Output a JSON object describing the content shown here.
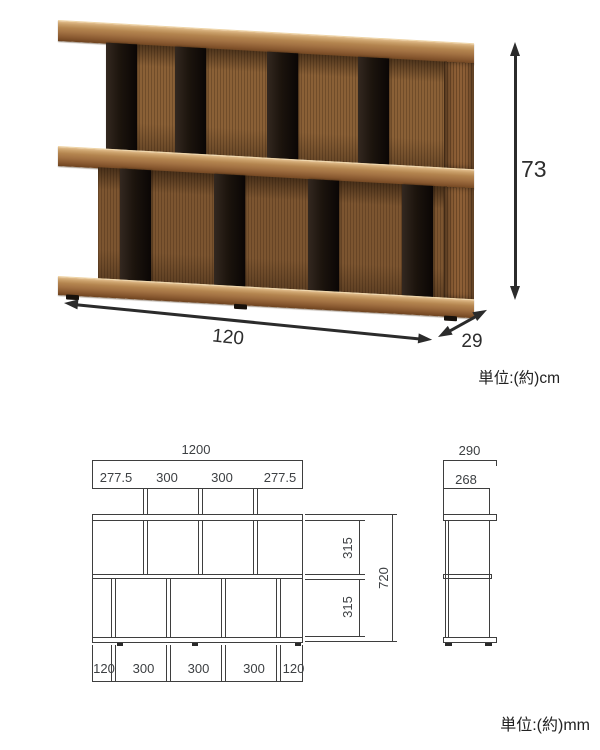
{
  "photo": {
    "height_cm": "73",
    "width_cm": "120",
    "depth_cm": "29",
    "unit_note": "単位:(約)cm"
  },
  "front_view": {
    "overall_width": "1200",
    "upper_segments": [
      "277.5",
      "300",
      "300",
      "277.5"
    ],
    "lower_segments": [
      "120",
      "300",
      "300",
      "300",
      "120"
    ],
    "upper_inner_height": "315",
    "lower_inner_height": "315",
    "overall_height": "720"
  },
  "side_view": {
    "depth": "290",
    "inner_depth": "268"
  },
  "drawing": {
    "unit_note": "単位:(約)mm"
  },
  "colors": {
    "line": "#3e3e3e",
    "arrow": "#2b2b2b",
    "wood_light": "#b4854f",
    "wood_mid": "#8a6036",
    "wood_dark": "#7c5530",
    "divider_black": "#1c140d"
  }
}
